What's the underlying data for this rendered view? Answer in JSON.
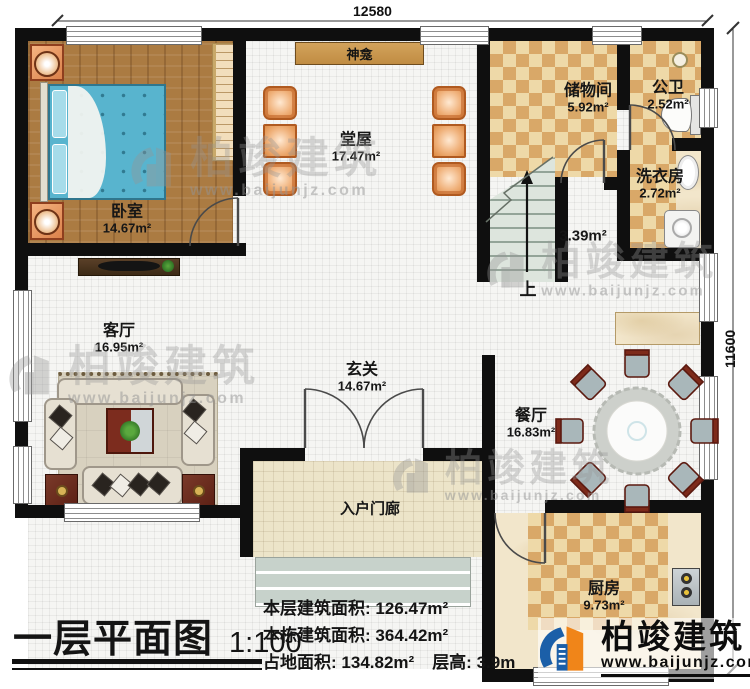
{
  "dimensions": {
    "top": "12580",
    "right": "11600"
  },
  "rooms": {
    "bedroom": {
      "name": "卧室",
      "area": "14.67m²"
    },
    "hall": {
      "name": "堂屋",
      "area": "17.47m²"
    },
    "shrine": {
      "name": "神龛"
    },
    "storage": {
      "name": "储物间",
      "area": "5.92m²"
    },
    "bathroom": {
      "name": "公卫",
      "area": "2.52m²"
    },
    "laundry": {
      "name": "洗衣房",
      "area": "2.72m²"
    },
    "stairs": {
      "area": "3.39m²",
      "direction": "上"
    },
    "living": {
      "name": "客厅",
      "area": "16.95m²"
    },
    "foyer": {
      "name": "玄关",
      "area": "14.67m²"
    },
    "dining": {
      "name": "餐厅",
      "area": "16.83m²"
    },
    "kitchen": {
      "name": "厨房",
      "area": "9.73m²"
    },
    "porch": {
      "name": "入户门廊"
    }
  },
  "title": {
    "text": "一层平面图",
    "scale": "1:100"
  },
  "stats": {
    "floor_area_label": "本层建筑面积:",
    "floor_area_value": "126.47m²",
    "building_area_label": "本栋建筑面积:",
    "building_area_value": "364.42m²",
    "land_area_label": "占地面积:",
    "land_area_value": "134.82m²",
    "height_label": "层高:",
    "height_value": "3.9m"
  },
  "brand": {
    "name": "柏竣建筑",
    "website": "www.baijunjz.com"
  },
  "watermark": {
    "name": "柏竣建筑",
    "website": "www.baijunjz.com"
  },
  "colors": {
    "wall": "#0f0f0f",
    "checker_dark": "#d9a868",
    "checker_light": "#eed9a8",
    "wood": "#ab7b42",
    "brand_blue": "#1b5fa8",
    "brand_orange": "#f08519"
  }
}
